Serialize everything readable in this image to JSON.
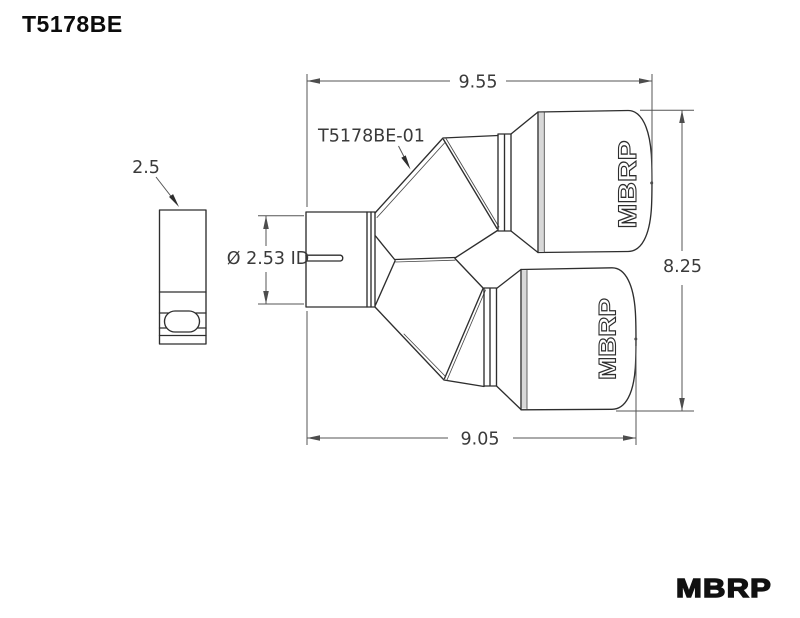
{
  "title": "T5178BE",
  "drawing": {
    "part_label": "T5178BE-01",
    "dim_top_width": "9.55",
    "dim_overall_height": "8.25",
    "dim_bottom_width": "9.05",
    "dim_inlet_length": "2.5",
    "dim_inlet_diameter": "Ø 2.53 ID",
    "tip_logo_upper": "MBRP",
    "tip_logo_lower": "MBRP"
  },
  "footer": {
    "brand": "MBRP"
  },
  "colors": {
    "line": "#2e2e2e",
    "dimension": "#555555",
    "background": "#ffffff",
    "shading": "#d8d8d8"
  }
}
